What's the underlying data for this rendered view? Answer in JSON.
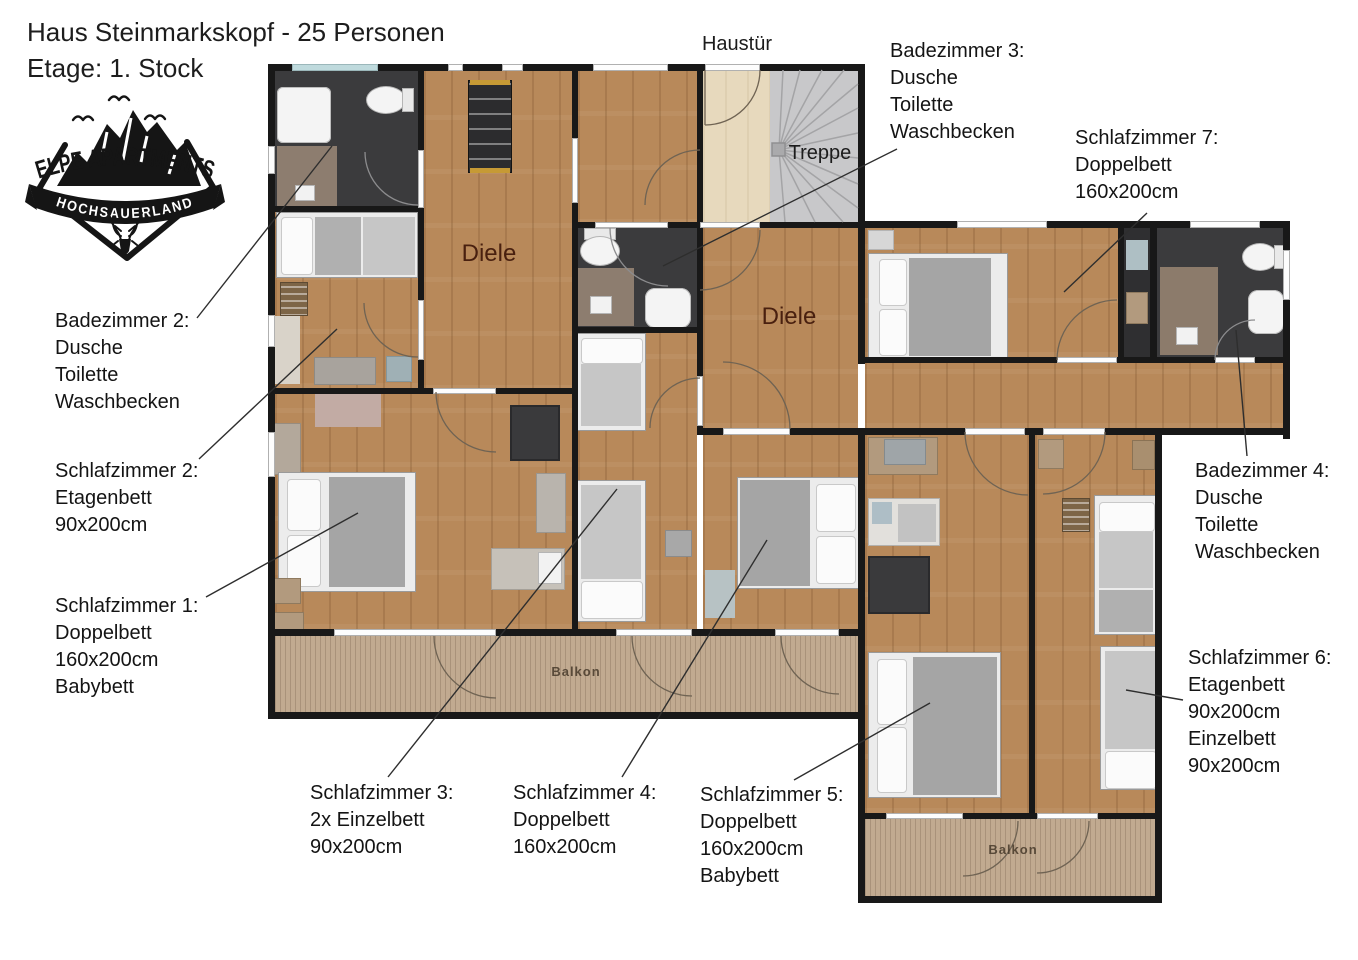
{
  "header": {
    "title": "Haus Steinmarkskopf - 25 Personen",
    "subtitle": "Etage: 1. Stock"
  },
  "logo": {
    "name": "ELPE APARTMENTS",
    "region": "HOCHSAUERLAND"
  },
  "plan": {
    "haustuer": "Haustür",
    "treppe": "Treppe",
    "diele1": "Diele",
    "diele2": "Diele",
    "balkon1": "Balkon",
    "balkon2": "Balkon"
  },
  "annotations": {
    "badezimmer_2": {
      "lines": [
        "Badezimmer 2:",
        "Dusche",
        "Toilette",
        "Waschbecken"
      ]
    },
    "schlafzimmer_2": {
      "lines": [
        "Schlafzimmer 2:",
        "Etagenbett",
        "90x200cm"
      ]
    },
    "schlafzimmer_1": {
      "lines": [
        "Schlafzimmer 1:",
        "Doppelbett",
        "160x200cm",
        "Babybett"
      ]
    },
    "schlafzimmer_3": {
      "lines": [
        "Schlafzimmer 3:",
        "2x Einzelbett",
        "90x200cm"
      ]
    },
    "schlafzimmer_4": {
      "lines": [
        "Schlafzimmer 4:",
        "Doppelbett",
        "160x200cm"
      ]
    },
    "schlafzimmer_5": {
      "lines": [
        "Schlafzimmer 5:",
        "Doppelbett",
        "160x200cm",
        "Babybett"
      ]
    },
    "schlafzimmer_6": {
      "lines": [
        "Schlafzimmer 6:",
        "Etagenbett",
        "90x200cm",
        "Einzelbett",
        "90x200cm"
      ]
    },
    "schlafzimmer_7": {
      "lines": [
        "Schlafzimmer 7:",
        "Doppelbett",
        "160x200cm"
      ]
    },
    "badezimmer_3": {
      "lines": [
        "Badezimmer 3:",
        "Dusche",
        "Toilette",
        "Waschbecken"
      ]
    },
    "badezimmer_4": {
      "lines": [
        "Badezimmer 4:",
        "Dusche",
        "Toilette",
        "Waschbecken"
      ]
    }
  },
  "colors": {
    "wall": "#181818",
    "wood_floor": "#b8895a",
    "dark_room": "#3b3b3d",
    "entry_floor": "#e7d9bd",
    "stairs": "#c8c8ca",
    "deck": "#c1aa90",
    "diele_label": "#49200f",
    "logo_ink": "#151515"
  }
}
